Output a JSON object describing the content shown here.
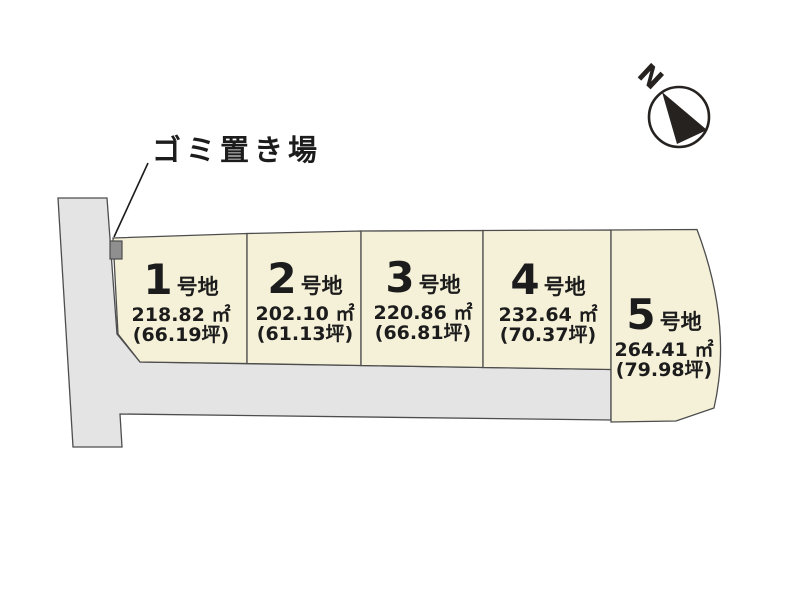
{
  "diagram": {
    "garbage_label": "ゴミ置き場",
    "compass_north": "N"
  },
  "plots": [
    {
      "number": "1",
      "suffix": "号地",
      "area": "218.82 ㎡",
      "tsubo": "(66.19坪)"
    },
    {
      "number": "2",
      "suffix": "号地",
      "area": "202.10 ㎡",
      "tsubo": "(61.13坪)"
    },
    {
      "number": "3",
      "suffix": "号地",
      "area": "220.86 ㎡",
      "tsubo": "(66.81坪)"
    },
    {
      "number": "4",
      "suffix": "号地",
      "area": "232.64 ㎡",
      "tsubo": "(70.37坪)"
    },
    {
      "number": "5",
      "suffix": "号地",
      "area": "264.41 ㎡",
      "tsubo": "(79.98坪)"
    }
  ],
  "colors": {
    "plot_fill": "#f5f1d8",
    "road_fill": "#e5e4e5",
    "outline": "#4d4d4d",
    "text": "#1c1c1c",
    "garbage_box_fill": "#8f8f8f",
    "compass_ink": "#262220",
    "background": "#ffffff"
  }
}
